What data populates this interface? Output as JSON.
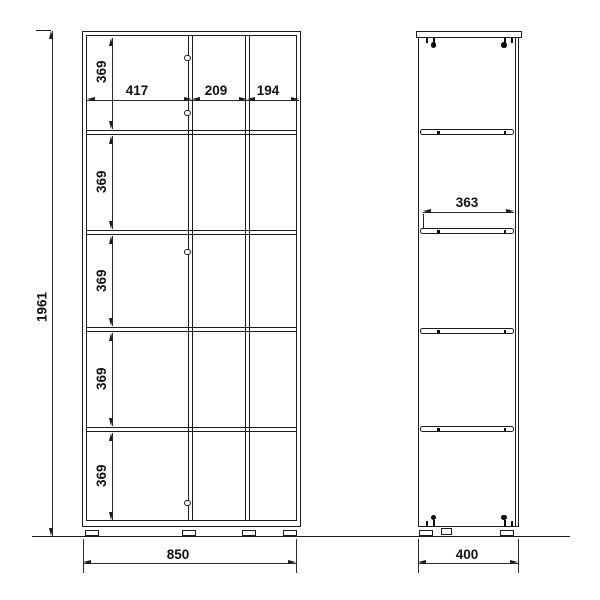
{
  "page": {
    "background": "#ffffff",
    "line_color": "#1c1c1c",
    "text_color": "#111111"
  },
  "drawing": {
    "type": "furniture-technical-drawing",
    "views": {
      "front": {
        "overall_height": "1961",
        "overall_width": "850",
        "column_widths": [
          "417",
          "209",
          "194"
        ],
        "row_heights": [
          "369",
          "369",
          "369",
          "369",
          "369"
        ]
      },
      "side": {
        "shelf_depth": "363",
        "overall_depth": "400"
      }
    },
    "icons": [
      "hinge-icon",
      "handle-hole-icon",
      "mounting-pin-icon",
      "shelf-pin-icon",
      "foot-icon",
      "ground-line"
    ]
  }
}
